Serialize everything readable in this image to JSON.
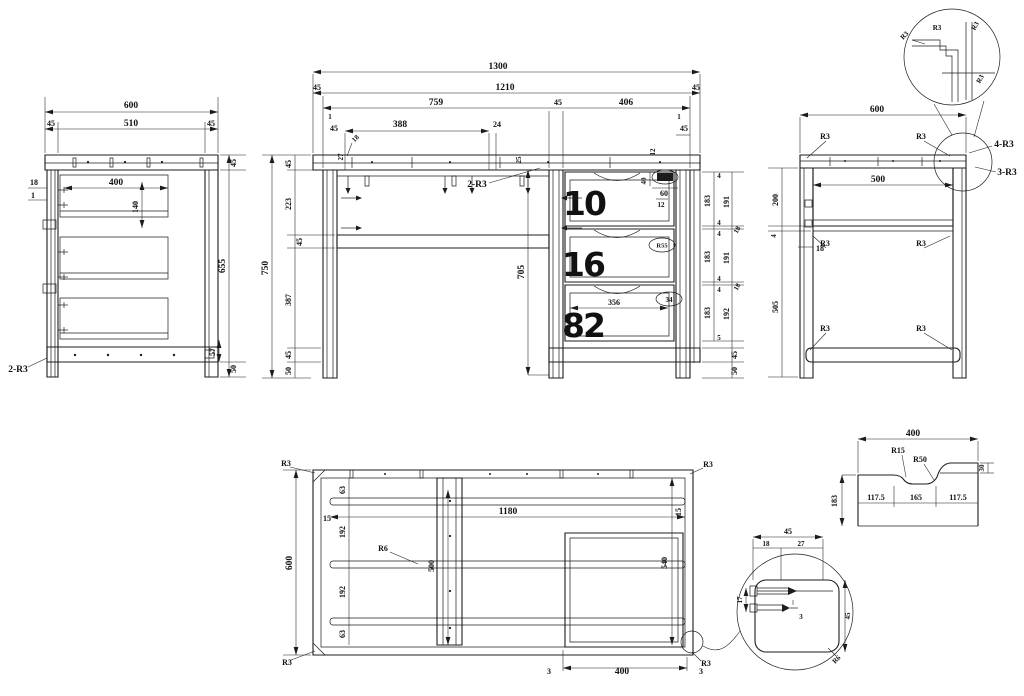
{
  "colors": {
    "background": "#ffffff",
    "line": "#1c1c1c"
  },
  "left_view": {
    "dim_600": "600",
    "dim_45l": "45",
    "dim_510": "510",
    "dim_45r": "45",
    "dim_18": "18",
    "dim_1": "1",
    "dim_400": "400",
    "dim_140": "140",
    "dim_45t": "45",
    "dim_655": "655",
    "dim_57": "57",
    "dim_50": "50",
    "callout_2r3": "2-R3"
  },
  "front_view": {
    "dim_1300": "1300",
    "dim_45l": "45",
    "dim_1210": "1210",
    "dim_45r": "45",
    "dim_759": "759",
    "dim_45m": "45",
    "dim_406": "406",
    "dim_1l": "1",
    "dim_45ll": "45",
    "dim_388": "388",
    "dim_24": "24",
    "dim_18": "18",
    "dim_27": "27",
    "dim_25": "25",
    "callout_2r3": "2-R3",
    "dim_1r": "1",
    "dim_45lr": "45",
    "dim_12": "12",
    "dim_750": "750",
    "chain_left": [
      "45",
      "223",
      "45",
      "387",
      "45",
      "50"
    ],
    "dim_705": "705",
    "handle": {
      "d40": "40",
      "d60": "60",
      "d12": "12"
    },
    "drawers": [
      "10",
      "16",
      "82"
    ],
    "stamp2": "R55",
    "stamp3": "34",
    "dim_356": "356",
    "chain_inner": [
      "4",
      "183",
      "4",
      "4",
      "183",
      "4",
      "4",
      "183",
      "5"
    ],
    "chain_outer": [
      "191",
      "18",
      "191",
      "18",
      "192",
      "45",
      "50"
    ]
  },
  "right_view": {
    "dim_600": "600",
    "dim_500": "500",
    "dim_200": "200",
    "dim_4": "4",
    "dim_18": "18",
    "dim_505": "505",
    "r3": "R3",
    "callout_4r3": "4-R3",
    "callout_3r3": "3-R3"
  },
  "corner_detail": {
    "r3": "R3"
  },
  "bottom_view": {
    "r3": "R3",
    "dim_600": "600",
    "chain": [
      "63",
      "192",
      "192",
      "63"
    ],
    "dim_15l": "15",
    "dim_15r": "15",
    "callout_r6": "R6",
    "dim_1180": "1180",
    "dim_500": "500",
    "dim_540": "540",
    "dim_3l": "3",
    "dim_400": "400",
    "dim_3r": "3"
  },
  "profile_detail": {
    "dim_400": "400",
    "r15": "R15",
    "r50": "R50",
    "dim_30": "30",
    "d117l": "117.5",
    "d165": "165",
    "d117r": "117.5",
    "dim_183": "183"
  },
  "leg_detail": {
    "dim_45t": "45",
    "dim_18": "18",
    "dim_27": "27",
    "dim_17": "17",
    "dim_3": "3",
    "dim_45r": "45",
    "r6": "R6"
  }
}
